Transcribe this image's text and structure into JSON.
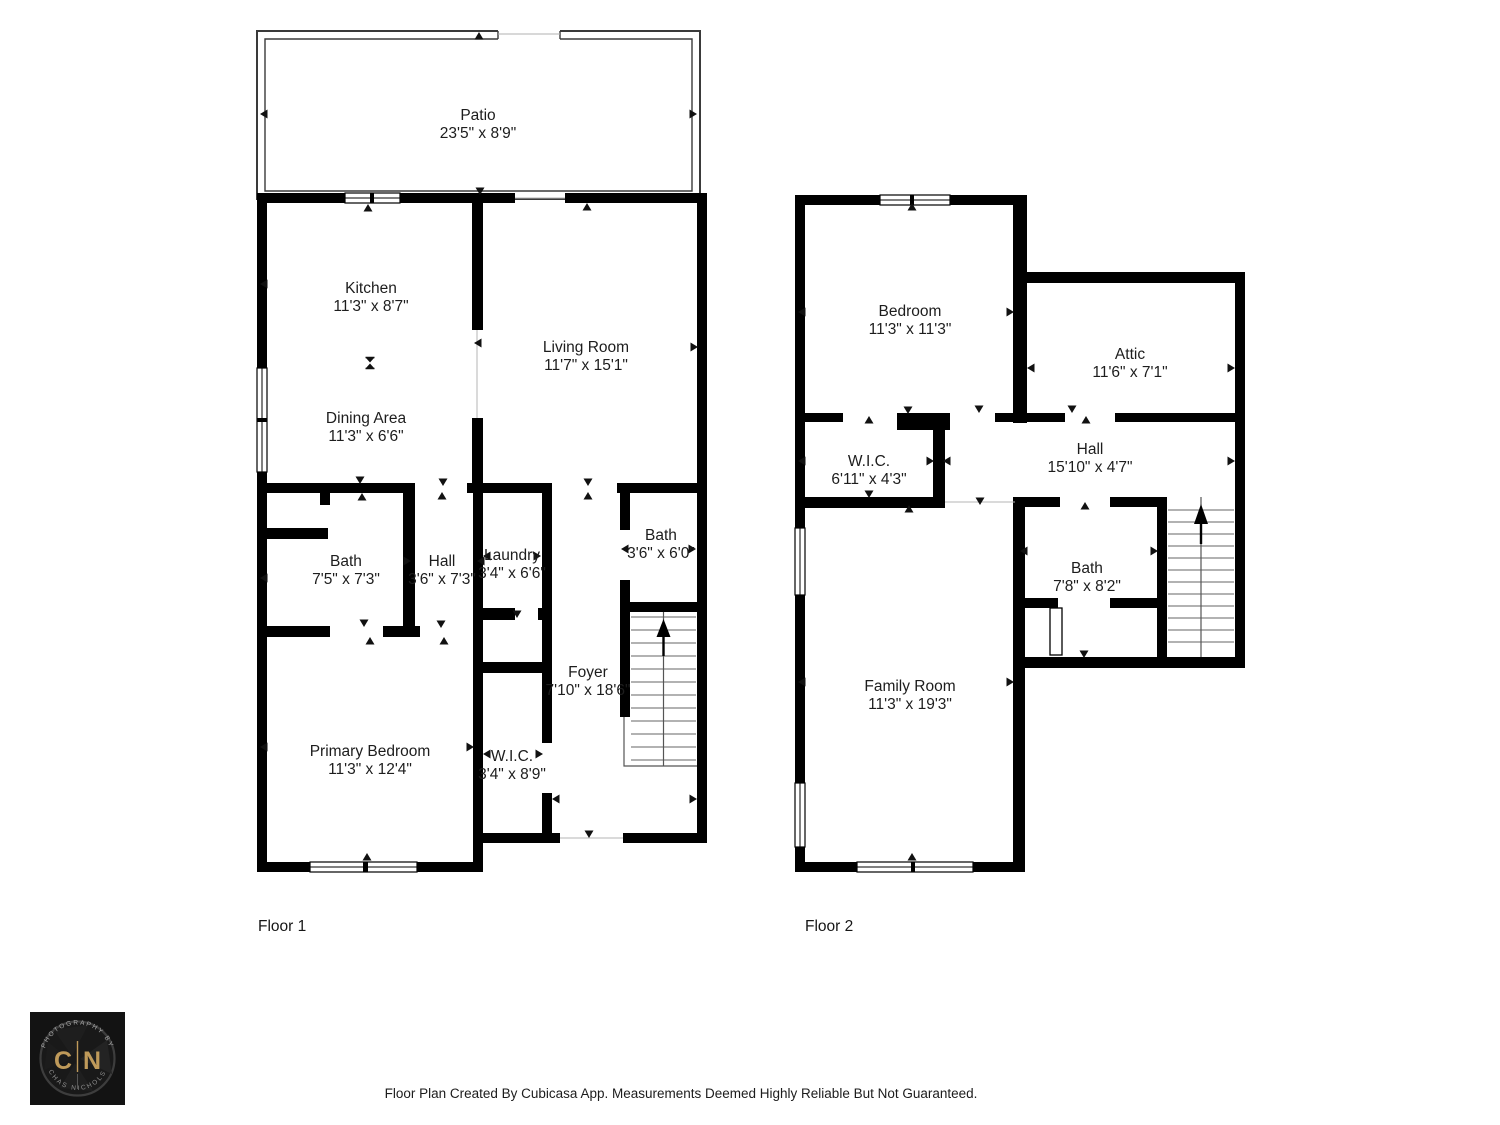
{
  "floors": [
    {
      "label": "Floor 1",
      "rooms": [
        {
          "name": "Patio",
          "dims": "23'5\" x 8'9\""
        },
        {
          "name": "Kitchen",
          "dims": "11'3\" x 8'7\""
        },
        {
          "name": "Living Room",
          "dims": "11'7\" x 15'1\""
        },
        {
          "name": "Dining Area",
          "dims": "11'3\" x 6'6\""
        },
        {
          "name": "Bath",
          "dims": "7'5\" x 7'3\""
        },
        {
          "name": "Hall",
          "dims": "3'6\" x 7'3\""
        },
        {
          "name": "Laundry",
          "dims": "3'4\" x 6'6\""
        },
        {
          "name": "Bath",
          "dims": "3'6\" x 6'0\""
        },
        {
          "name": "Foyer",
          "dims": "7'10\" x 18'6\""
        },
        {
          "name": "Primary Bedroom",
          "dims": "11'3\" x 12'4\""
        },
        {
          "name": "W.I.C.",
          "dims": "3'4\" x 8'9\""
        }
      ]
    },
    {
      "label": "Floor 2",
      "rooms": [
        {
          "name": "Bedroom",
          "dims": "11'3\" x 11'3\""
        },
        {
          "name": "Attic",
          "dims": "11'6\" x 7'1\""
        },
        {
          "name": "W.I.C.",
          "dims": "6'11\" x 4'3\""
        },
        {
          "name": "Hall",
          "dims": "15'10\" x 4'7\""
        },
        {
          "name": "Bath",
          "dims": "7'8\" x 8'2\""
        },
        {
          "name": "Family Room",
          "dims": "11'3\" x 19'3\""
        }
      ]
    }
  ],
  "footer": {
    "text": "Floor Plan Created By Cubicasa App. Measurements Deemed Highly Reliable But Not Guaranteed."
  },
  "logo": {
    "top_arc": "PHOTOGRAPHY BY",
    "bottom_arc": "CHAS NICHOLS",
    "initial_left": "C",
    "initial_right": "N",
    "colors": {
      "background": "#131313",
      "gold": "#bf9a5a",
      "ring": "#3d3d3d",
      "arc_text": "#a7a7a7",
      "wall": "#000000"
    }
  }
}
